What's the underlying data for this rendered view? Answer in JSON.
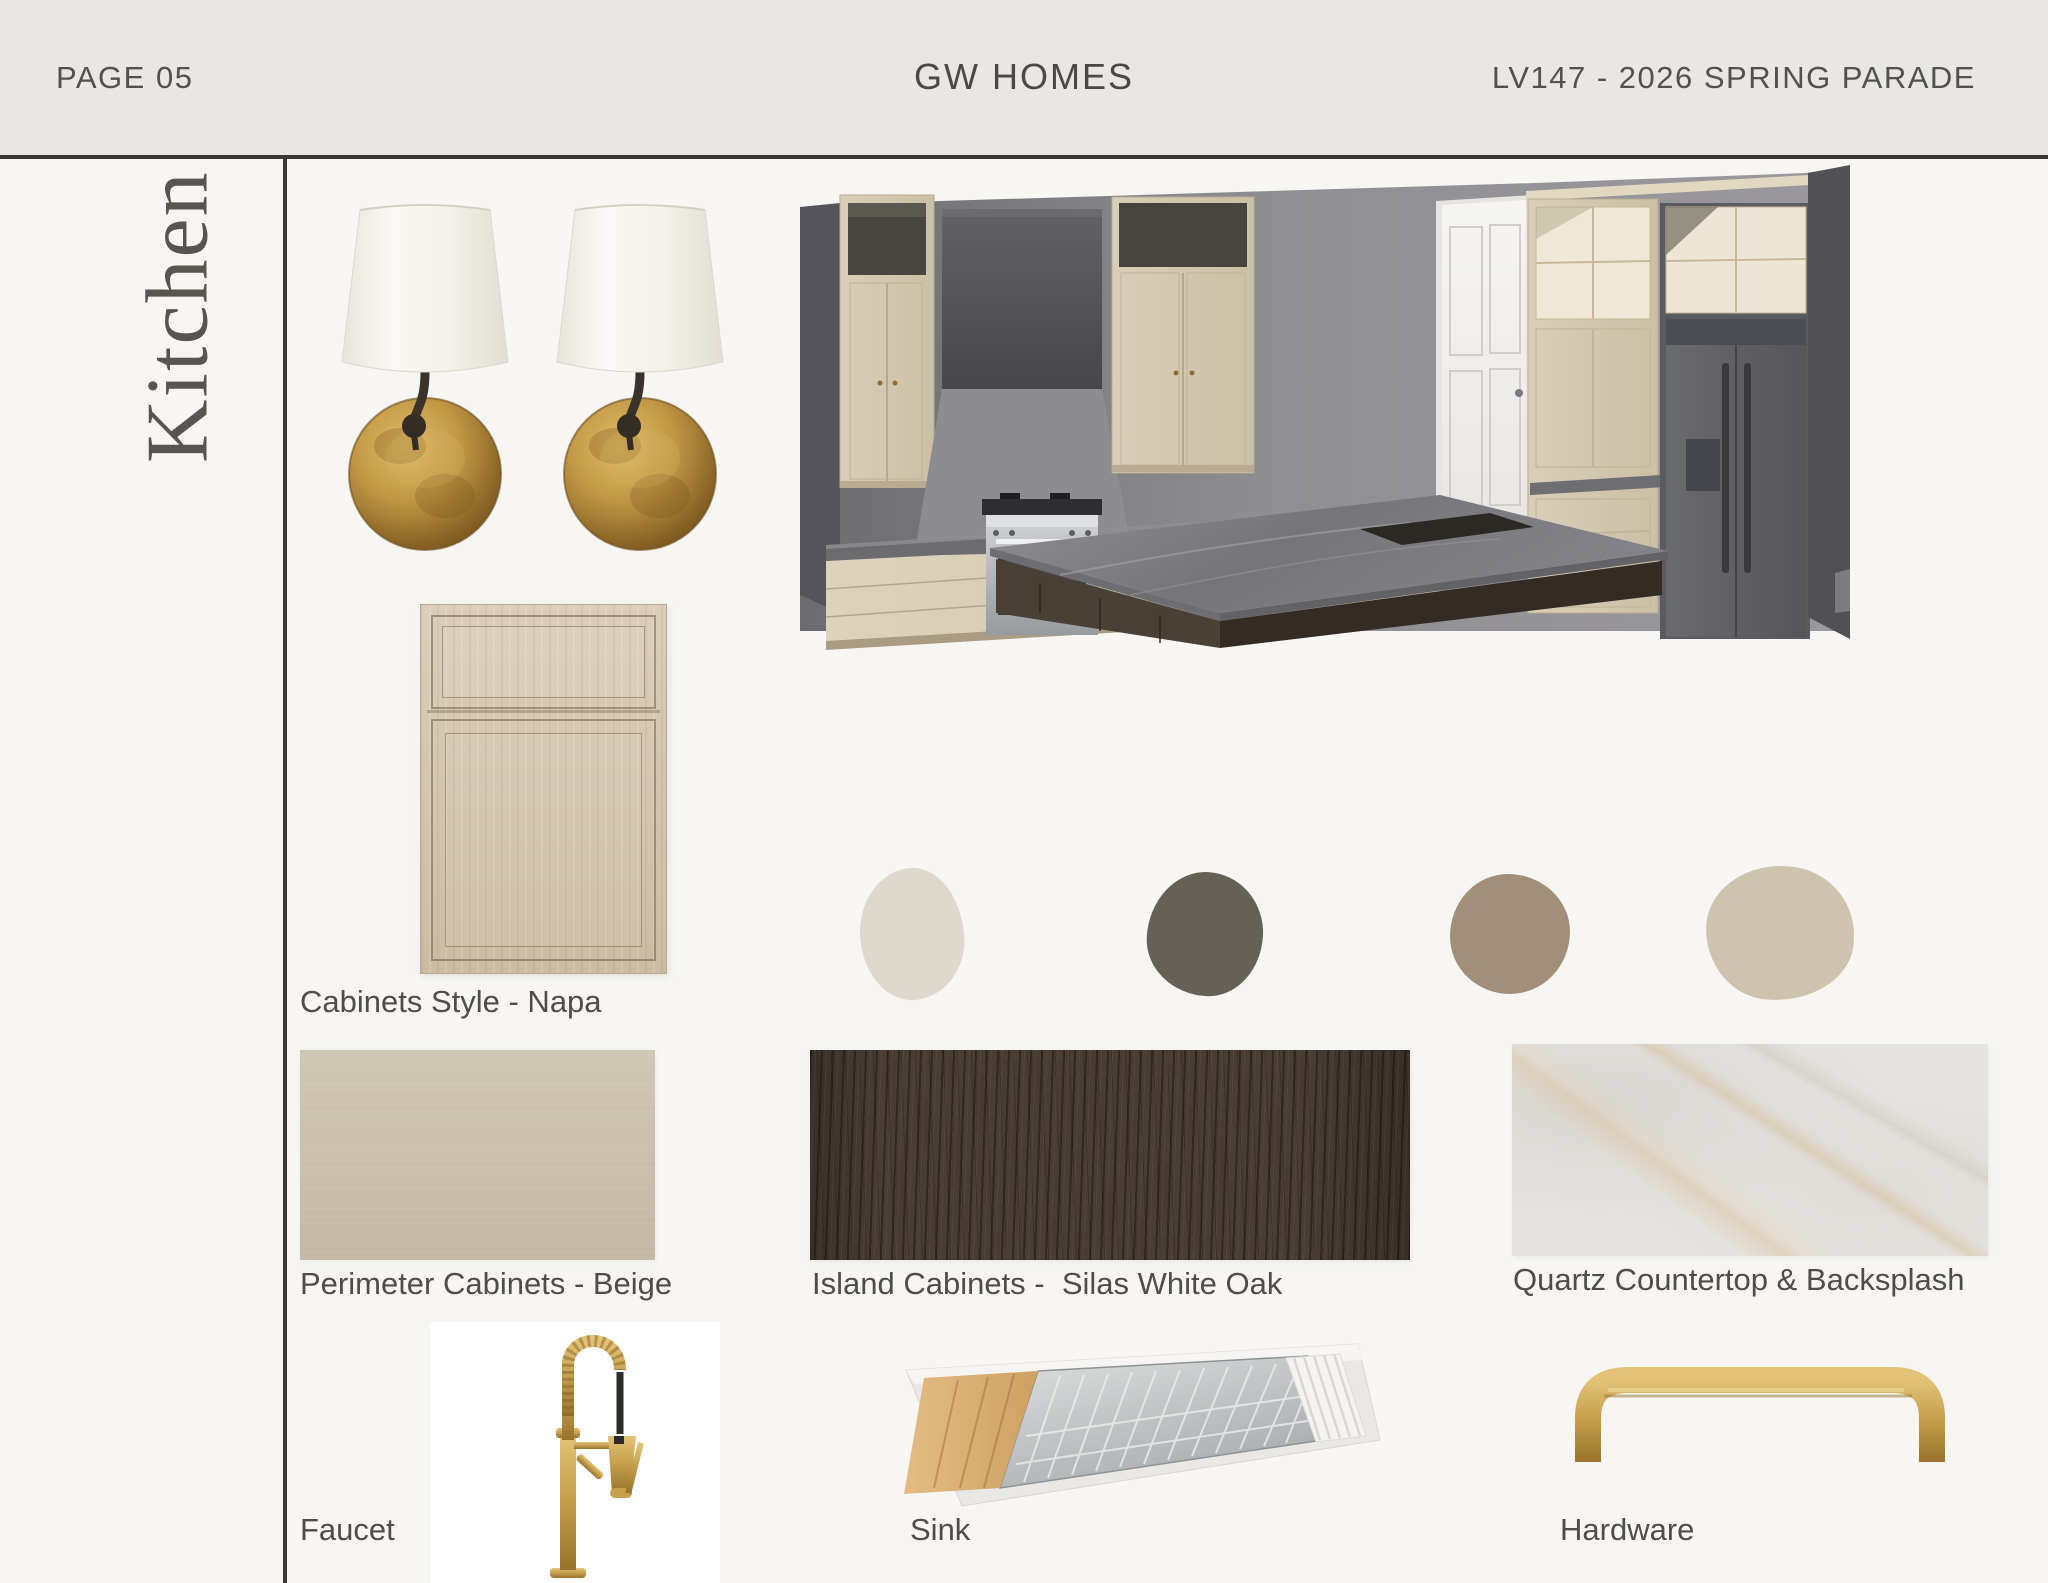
{
  "header": {
    "page_label": "PAGE 05",
    "brand": "GW HOMES",
    "project_code": "LV147 - 2026 SPRING PARADE"
  },
  "sidebar": {
    "title": "Kitchen"
  },
  "board": {
    "cabinet_style_label": "Cabinets Style - Napa",
    "perimeter_label": "Perimeter Cabinets - Beige",
    "island_label": "Island Cabinets -  Silas White Oak",
    "quartz_label": "Quartz Countertop & Backsplash",
    "faucet_label": "Faucet",
    "sink_label": "Sink",
    "hardware_label": "Hardware"
  },
  "palette": [
    {
      "name": "cream",
      "hex": "#ded9cc"
    },
    {
      "name": "charcoal",
      "hex": "#656157"
    },
    {
      "name": "taupe",
      "hex": "#a18f79"
    },
    {
      "name": "beige",
      "hex": "#cec3af"
    }
  ],
  "materials": {
    "perimeter_hex": "#cbc0ac",
    "island_hex": "#483c33",
    "quartz_hex": "#e6e4e0",
    "cabinet_sample_hex": "#d5c7b0"
  },
  "accents": {
    "brass": "#c6a250",
    "bronze": "#3a342e"
  }
}
